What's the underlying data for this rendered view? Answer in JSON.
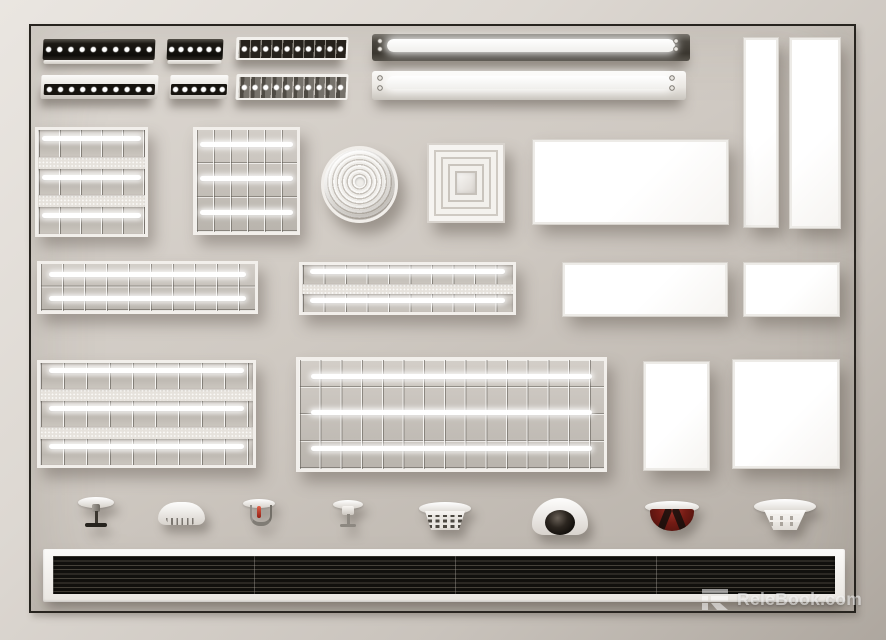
{
  "watermark": {
    "logo": "relebook-logo",
    "text": "ReleBook.com"
  },
  "background": {
    "outer": "#d9d4ce",
    "wall": "#c9c3bc",
    "frame_border": "#27241f"
  },
  "palette": {
    "fixture_white": "#f3f1ed",
    "spot_face_black": "#15120d",
    "lamp_glow": "#ffffff",
    "metal_dark": "#3f3b35",
    "alarm_red": "#731b14",
    "camera_lens": "#1c1713",
    "grille_black": "#11100d"
  },
  "fixtures": [
    {
      "id": "linear-spot-black-long",
      "label": "recessed linear spotlight, black face",
      "spots": 10
    },
    {
      "id": "linear-spot-black-short",
      "label": "recessed linear spotlight, black face",
      "spots": 6
    },
    {
      "id": "linear-spot-cells-top",
      "label": "linear grille spotlight, white frame",
      "spots": 10
    },
    {
      "id": "linear-spot-white-long",
      "label": "surface linear spotlight, white body",
      "spots": 10
    },
    {
      "id": "linear-spot-white-short",
      "label": "surface linear spotlight, white body",
      "spots": 6
    },
    {
      "id": "linear-spot-cells-bottom",
      "label": "linear grille spotlight, metallic cells",
      "spots": 10
    },
    {
      "id": "batten-dark",
      "label": "LED batten light, dark grey housing",
      "lamps": 1
    },
    {
      "id": "batten-white",
      "label": "LED batten light, white housing",
      "lamps": 1
    },
    {
      "id": "panel-vertical-narrow",
      "label": "LED panel, vertical narrow"
    },
    {
      "id": "panel-vertical-wide",
      "label": "LED panel, vertical wide"
    },
    {
      "id": "louvre-square-strips",
      "label": "square louvre fixture with perforated bands",
      "cols": 5,
      "lamps": 3
    },
    {
      "id": "louvre-square-grid",
      "label": "square grid louvre fixture",
      "cols": 6,
      "lamps": 3
    },
    {
      "id": "diffuser-round",
      "label": "round ribbed ceiling diffuser"
    },
    {
      "id": "diffuser-square",
      "label": "square cone ceiling diffuser"
    },
    {
      "id": "panel-horizontal-large",
      "label": "LED panel, horizontal large"
    },
    {
      "id": "louvre-strip-a",
      "label": "louvre strip fixture",
      "cols": 10,
      "lamps": 2
    },
    {
      "id": "louvre-strip-b",
      "label": "louvre strip fixture with perforated band",
      "cols": 10,
      "lamps": 2
    },
    {
      "id": "panel-horizontal-medium",
      "label": "LED panel, horizontal medium"
    },
    {
      "id": "panel-horizontal-small",
      "label": "LED panel, horizontal small"
    },
    {
      "id": "louvre-large-strips",
      "label": "large louvre fixture with perforated bands",
      "cols": 9,
      "lamps": 3
    },
    {
      "id": "louvre-large-grid",
      "label": "large grid louvre fixture",
      "cols": 15,
      "rows": 4,
      "lamps": 3
    },
    {
      "id": "panel-portrait",
      "label": "LED panel, portrait"
    },
    {
      "id": "panel-square",
      "label": "LED panel, square"
    },
    {
      "id": "sprinkler-pendent",
      "label": "fire sprinkler, pendent with escutcheon"
    },
    {
      "id": "smoke-detector-dome",
      "label": "smoke detector, white dome"
    },
    {
      "id": "sprinkler-red-bulb",
      "label": "fire sprinkler with red glass bulb"
    },
    {
      "id": "sprinkler-concealed",
      "label": "fire sprinkler, concealed white"
    },
    {
      "id": "heat-detector-vented",
      "label": "heat detector with vent slots"
    },
    {
      "id": "dome-camera",
      "label": "security dome camera"
    },
    {
      "id": "alarm-sounder-red",
      "label": "fire alarm sounder, red dome"
    },
    {
      "id": "smoke-detector-vented",
      "label": "smoke detector with vent slots"
    },
    {
      "id": "linear-slot-diffuser",
      "label": "linear slot diffuser, black grille",
      "slats": 9,
      "sections": 4
    }
  ]
}
